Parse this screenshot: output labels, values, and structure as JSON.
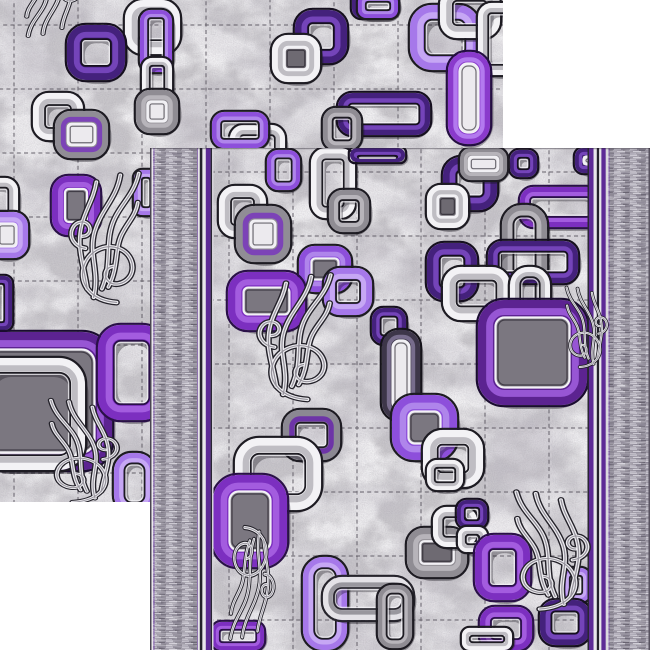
{
  "description": "Product photo of a grey marbled carpet runner with purple, violet, white and grey interlocking chain-link squares and feather scroll ornaments; two overlapping offset views of the same rug on a white background, the front view with heathered grey side border bands and purple pin stripes",
  "page_background": "#ffffff",
  "palette": {
    "field_base": "#c9c7cb",
    "grid_line": "#6b6770",
    "grid_light": "#dedce0",
    "hatch_base": "#8b8694",
    "stripe_purple": "#5d2a96",
    "stripe_dark": "#23212b",
    "stripe_white": "#e8e6eb",
    "edge_dark": "#56515e"
  },
  "ring_styles": {
    "white": {
      "band": "#f3f2f5",
      "band2": "#bcb9c0",
      "edge": "#1d1b22"
    },
    "gray": {
      "band": "#8f8c93",
      "band2": "#b9b6bc",
      "edge": "#1d1b22"
    },
    "graylight": {
      "band": "#e4e2e7",
      "band2": "#95929a",
      "edge": "#26242c"
    },
    "violet": {
      "band": "#8d4fdb",
      "band2": "#b188ec",
      "edge": "#1d1b22"
    },
    "amethyst": {
      "band": "#a678ea",
      "band2": "#c7aaf4",
      "edge": "#1d1b22"
    },
    "purple": {
      "band": "#7c2fc0",
      "band2": "#a55fe0",
      "edge": "#2a1048"
    },
    "bigpurple": {
      "band": "#5c2391",
      "band2": "#9a5ad8",
      "edge": "#1a0c30"
    },
    "darkviolet": {
      "band": "#44217c",
      "band2": "#7747bd",
      "edge": "#16101f"
    },
    "grayviolet": {
      "band": "#908d95",
      "band2": "#7b3fb8",
      "edge": "#1d1b22"
    },
    "graypurple": {
      "band": "#8b8892",
      "band2": "#6b2fa9",
      "edge": "#1d1b22"
    },
    "purplecapsule": {
      "band": "#8a3acc",
      "band2": "#b57cf0",
      "edge": "#240d42"
    },
    "capsule": {
      "band": "#3d3649",
      "band2": "#7a7090",
      "edge": "#15131a"
    }
  },
  "fill_colors": {
    "gray": "#7b7780",
    "dgray": "#6e6a72",
    "white": "#eceaee"
  },
  "feather_paths": [
    "M55,168 C28,166 14,147 19,127 C24,109 41,99 57,105 C70,110 76,125 70,137 C64,147 51,150 45,142 C40,135 44,127 51,126",
    "M30,162 C37,132 24,112 31,86 C38,60 55,47 59,20",
    "M39,152 C51,122 41,96 53,70 C61,52 74,42 79,18",
    "M23,152 C19,122 11,104 17,78 C21,60 30,48 33,28",
    "M46,150 C58,126 52,104 62,86 C68,74 76,66 78,52",
    "M21,105 C9,103 3,92 7,82 C11,73 21,72 25,79 C28,85 24,91 18,91"
  ],
  "feather_stroke": {
    "outline": "#232129",
    "light": "#ecebef",
    "mid": "#95929b"
  },
  "grid_style": {
    "color": "#6b6770",
    "light": "#dedce0",
    "width": 1.5,
    "dash": "4 3.2",
    "opacity": 0.7
  },
  "mottle_layers": [
    {
      "filter": "fLight",
      "opacity": 0.95
    },
    {
      "filter": "fDark",
      "opacity": 0.6
    },
    {
      "filter": "fGrain",
      "opacity": 0.3
    }
  ],
  "carpets": [
    {
      "id": "back-carpet",
      "x": 0,
      "y": 0,
      "w": 503,
      "h": 502,
      "field": null,
      "borders": null,
      "grid": {
        "v": [
          14,
          78,
          142,
          206,
          270,
          334,
          398,
          462
        ],
        "h": [
          25,
          89,
          153,
          217,
          281,
          345,
          409,
          473
        ]
      },
      "rings": [
        [
          125,
          0,
          55,
          54,
          "white",
          null
        ],
        [
          140,
          10,
          32,
          62,
          "violet",
          null
        ],
        [
          67,
          25,
          58,
          55,
          "darkviolet",
          null
        ],
        [
          142,
          58,
          30,
          52,
          "white",
          null
        ],
        [
          136,
          90,
          42,
          43,
          "gray",
          "white"
        ],
        [
          33,
          93,
          50,
          47,
          "white",
          null
        ],
        [
          55,
          111,
          53,
          47,
          "grayviolet",
          "white"
        ],
        [
          230,
          125,
          55,
          40,
          "white",
          null
        ],
        [
          52,
          176,
          48,
          59,
          "purple",
          "gray"
        ],
        [
          134,
          170,
          24,
          45,
          "amethyst",
          null
        ],
        [
          -20,
          178,
          38,
          44,
          "white",
          null
        ],
        [
          -14,
          212,
          42,
          46,
          "amethyst",
          "white"
        ],
        [
          -10,
          276,
          22,
          54,
          "darkviolet",
          null
        ],
        [
          295,
          10,
          52,
          53,
          "darkviolet",
          null
        ],
        [
          272,
          35,
          48,
          47,
          "white",
          "dgray"
        ],
        [
          352,
          -10,
          46,
          28,
          "darkviolet",
          null
        ],
        [
          358,
          -6,
          40,
          24,
          "violet",
          null
        ],
        [
          410,
          5,
          70,
          65,
          "amethyst",
          null,
          22,
          15
        ],
        [
          440,
          -12,
          60,
          50,
          "white",
          null
        ],
        [
          478,
          3,
          40,
          72,
          "white",
          null
        ],
        [
          448,
          52,
          42,
          92,
          "purplecapsule",
          "white",
          19,
          11
        ],
        [
          338,
          93,
          92,
          42,
          "darkviolet",
          null
        ],
        [
          323,
          108,
          38,
          42,
          "gray",
          null
        ],
        [
          212,
          112,
          56,
          36,
          "violet",
          null
        ],
        [
          -30,
          332,
          142,
          138,
          "bigpurple",
          "gray",
          30,
          17
        ],
        [
          98,
          325,
          67,
          95,
          "purple",
          null
        ],
        [
          -25,
          358,
          110,
          112,
          "white",
          null,
          26,
          15
        ],
        [
          114,
          453,
          41,
          60,
          "amethyst",
          null,
          18
        ]
      ],
      "feathers": [
        [
          8,
          -52,
          0.75,
          0.57,
          175,
          1
        ],
        [
          66,
          158,
          0.92,
          0.86,
          0,
          1
        ],
        [
          32,
          388,
          0.9,
          0.68,
          0,
          -1
        ]
      ]
    },
    {
      "id": "front-carpet",
      "x": 150,
      "y": 148,
      "w": 500,
      "h": 502,
      "field": [
        63.5,
        437.5
      ],
      "borders": {
        "left": [
          [
            0,
            1.5,
            "#56515e"
          ],
          [
            1.5,
            1.8,
            "#e6e4e9"
          ],
          [
            3.3,
            1.2,
            "#6a4099"
          ],
          [
            4.5,
            42.5,
            "hatch"
          ],
          [
            47,
            0.8,
            "#6a4099"
          ],
          [
            47.8,
            2,
            "#e8e6eb"
          ],
          [
            49.8,
            2.6,
            "#23212b"
          ],
          [
            52.4,
            3.4,
            "#e8e6eb"
          ],
          [
            55.8,
            4.8,
            "#5d2a96"
          ],
          [
            60.6,
            1.5,
            "#2a2733"
          ],
          [
            62.1,
            1.4,
            "#d9d7dc"
          ]
        ],
        "right": [
          [
            437.5,
            1.5,
            "#2a2733"
          ],
          [
            439,
            4.6,
            "#5d2a96"
          ],
          [
            443.6,
            3.2,
            "#e8e6eb"
          ],
          [
            446.8,
            2.4,
            "#23212b"
          ],
          [
            449.2,
            2.2,
            "#e8e6eb"
          ],
          [
            451.4,
            4.4,
            "#5d2a96"
          ],
          [
            455.8,
            2.7,
            "#d9d7dc"
          ],
          [
            458.5,
            1,
            "#6a4099"
          ],
          [
            459.5,
            39,
            "hatch"
          ],
          [
            498.5,
            1.5,
            "#56515e"
          ]
        ]
      },
      "grid": {
        "v": [
          79,
          143,
          207,
          271,
          335,
          399
        ],
        "h": [
          24,
          88,
          152,
          216,
          280,
          344,
          408,
          472
        ]
      },
      "rings": [
        [
          117,
          2,
          33,
          40,
          "violet",
          null
        ],
        [
          161,
          0,
          44,
          70,
          "white",
          null
        ],
        [
          179,
          42,
          40,
          42,
          "gray",
          null
        ],
        [
          69,
          38,
          47,
          51,
          "white",
          null
        ],
        [
          86,
          58,
          54,
          56,
          "grayviolet",
          "white"
        ],
        [
          293,
          9,
          54,
          53,
          "darkviolet",
          null
        ],
        [
          277,
          37,
          41,
          43,
          "white",
          "dgray"
        ],
        [
          360,
          2,
          27,
          27,
          "darkviolet",
          null
        ],
        [
          310,
          0,
          47,
          32,
          "gray",
          "white"
        ],
        [
          425,
          0,
          60,
          25,
          "darkviolet",
          "white"
        ],
        [
          200,
          0,
          55,
          14,
          "darkviolet",
          null
        ],
        [
          370,
          39,
          80,
          40,
          "purple",
          null
        ],
        [
          352,
          57,
          45,
          115,
          "gray",
          null,
          20
        ],
        [
          277,
          95,
          50,
          57,
          "darkviolet",
          null
        ],
        [
          338,
          93,
          90,
          42,
          "darkviolet",
          null
        ],
        [
          149,
          98,
          52,
          46,
          "violet",
          "gray"
        ],
        [
          174,
          120,
          48,
          47,
          "amethyst",
          null
        ],
        [
          78,
          124,
          77,
          58,
          "purple",
          "gray"
        ],
        [
          293,
          119,
          67,
          53,
          "white",
          null
        ],
        [
          360,
          119,
          40,
          83,
          "white",
          null,
          18
        ],
        [
          328,
          152,
          109,
          105,
          "bigpurple",
          "gray",
          26,
          17
        ],
        [
          222,
          160,
          34,
          36,
          "darkviolet",
          null
        ],
        [
          232,
          182,
          38,
          90,
          "capsule",
          "white",
          17,
          10
        ],
        [
          242,
          247,
          65,
          65,
          "violet",
          "gray"
        ],
        [
          273,
          282,
          60,
          57,
          "white",
          null
        ],
        [
          277,
          312,
          36,
          30,
          "white",
          null
        ],
        [
          133,
          262,
          57,
          50,
          "graypurple",
          null
        ],
        [
          85,
          290,
          86,
          72,
          "white",
          null
        ],
        [
          63,
          327,
          74,
          92,
          "purple",
          "gray"
        ],
        [
          153,
          409,
          44,
          93,
          "amethyst",
          null,
          20
        ],
        [
          173,
          429,
          90,
          43,
          "graylight",
          null,
          19
        ],
        [
          257,
          380,
          60,
          49,
          "gray",
          "dgray"
        ],
        [
          283,
          359,
          44,
          40,
          "white",
          null
        ],
        [
          307,
          352,
          30,
          28,
          "darkviolet",
          null
        ],
        [
          308,
          379,
          29,
          25,
          "white",
          null
        ],
        [
          228,
          437,
          34,
          63,
          "gray",
          null,
          14
        ],
        [
          325,
          387,
          55,
          65,
          "purple",
          null
        ],
        [
          412,
          420,
          28,
          34,
          "amethyst",
          null
        ],
        [
          390,
          452,
          50,
          45,
          "darkviolet",
          null
        ],
        [
          330,
          459,
          52,
          43,
          "purple",
          null
        ],
        [
          312,
          480,
          50,
          22,
          "white",
          null
        ],
        [
          62,
          474,
          52,
          28,
          "purple",
          null
        ]
      ],
      "feathers": [
        [
          104,
          112,
          0.97,
          0.83,
          0,
          1
        ],
        [
          68,
          378,
          0.59,
          0.74,
          180,
          1
        ],
        [
          405,
          130,
          0.55,
          0.53,
          0,
          -1
        ],
        [
          346,
          330,
          0.97,
          0.78,
          0,
          -1
        ]
      ]
    }
  ]
}
